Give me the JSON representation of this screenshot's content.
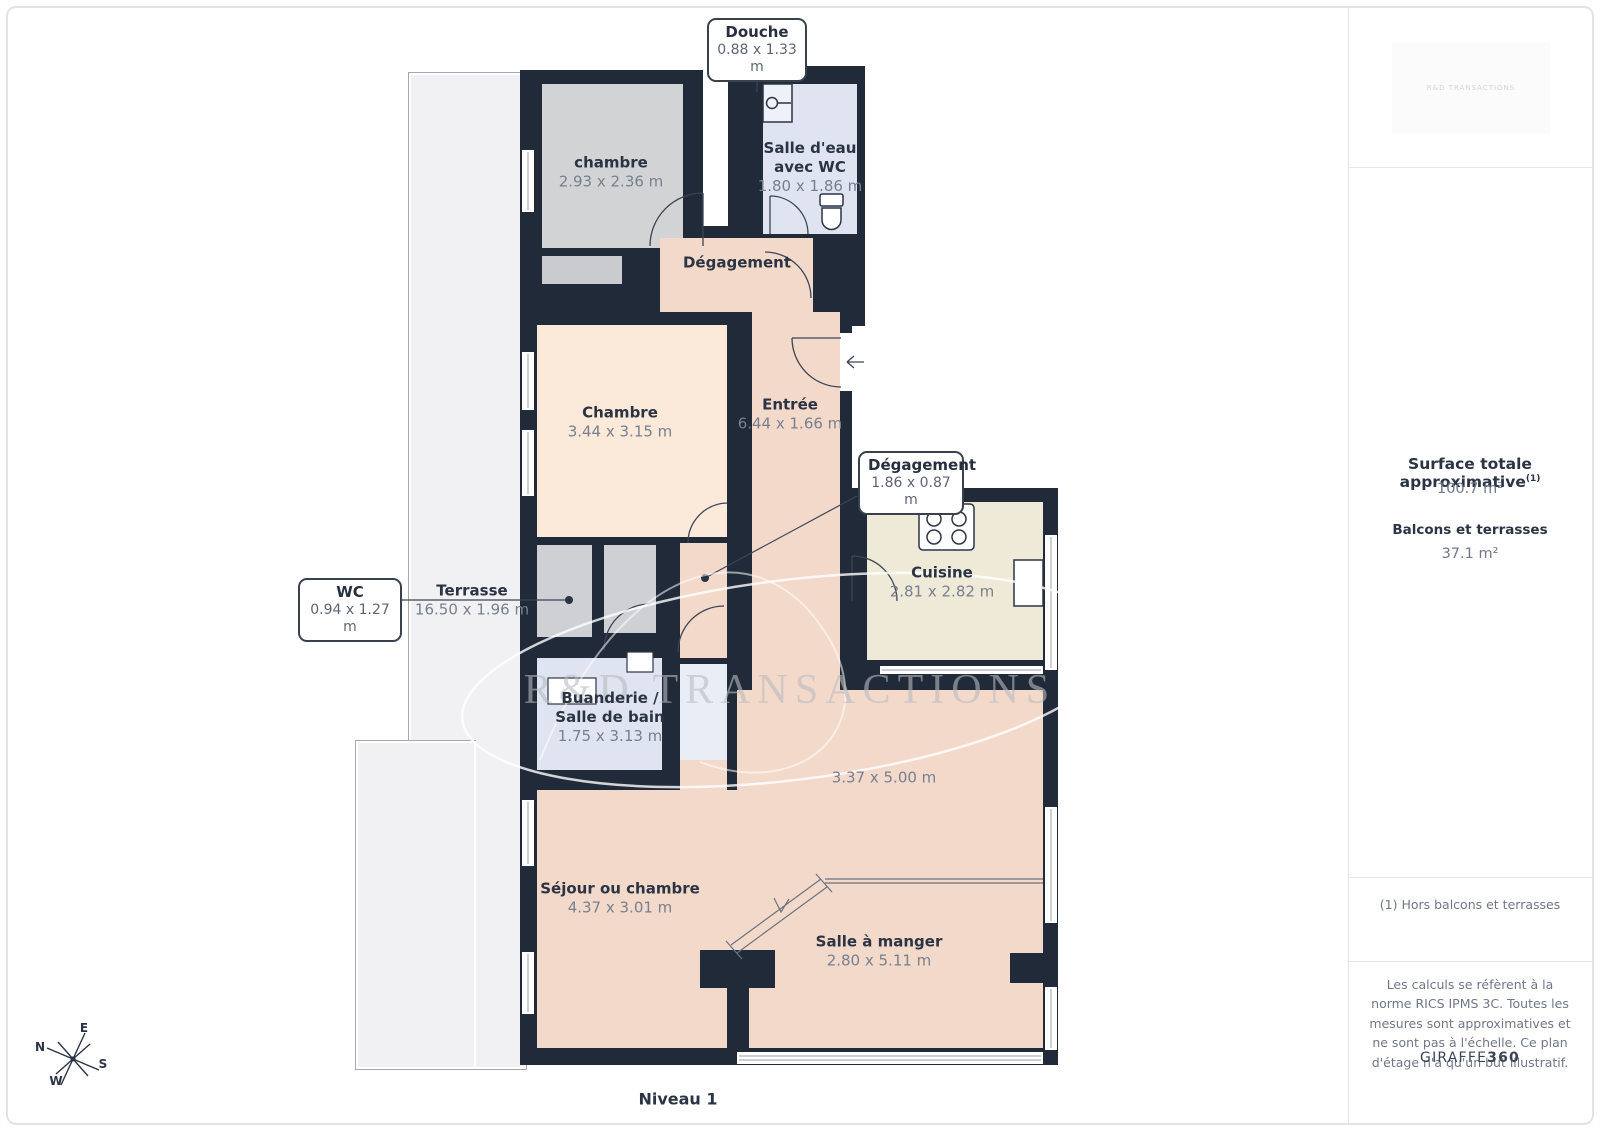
{
  "header": {
    "level_label": "Niveau 1"
  },
  "watermark": {
    "text": "R&D TRANSACTIONS",
    "logo_text": "R&D TRANSACTIONS"
  },
  "plan": {
    "rooms": [
      {
        "id": "chambre-1",
        "name": "chambre",
        "dims": "2.93 x 2.36 m"
      },
      {
        "id": "salle-deau",
        "name": "Salle d'eau avec WC",
        "dims": "1.80 x 1.86 m"
      },
      {
        "id": "degagement",
        "name": "Dégagement",
        "dims": ""
      },
      {
        "id": "chambre-2",
        "name": "Chambre",
        "dims": "3.44 x 3.15 m"
      },
      {
        "id": "entree",
        "name": "Entrée",
        "dims": "6.44 x 1.66 m"
      },
      {
        "id": "cuisine",
        "name": "Cuisine",
        "dims": "2.81 x 2.82 m"
      },
      {
        "id": "terrasse",
        "name": "Terrasse",
        "dims": "16.50 x 1.96 m"
      },
      {
        "id": "buanderie",
        "name": "Buanderie / Salle de bain",
        "dims": "1.75 x 3.13 m"
      },
      {
        "id": "sejour-zone",
        "name": "",
        "dims": "3.37 x 5.00 m"
      },
      {
        "id": "sejour",
        "name": "Séjour ou chambre",
        "dims": "4.37 x 3.01 m"
      },
      {
        "id": "salle-a-manger",
        "name": "Salle à manger",
        "dims": "2.80 x 5.11 m"
      }
    ],
    "callouts": [
      {
        "title": "Douche",
        "dims": "0.88 x 1.33 m"
      },
      {
        "title": "WC",
        "dims": "0.94 x 1.27 m"
      },
      {
        "title": "Dégagement",
        "dims": "1.86 x 0.87 m"
      }
    ],
    "compass": {
      "n": "N",
      "e": "E",
      "s": "S",
      "w": "W"
    }
  },
  "sidebar": {
    "surface_title": "Surface totale approximative",
    "surface_footnote_mark": "(1)",
    "surface_value": "100.7 m²",
    "balconies_title": "Balcons et terrasses",
    "balconies_value": "37.1 m²",
    "footnote": "(1) Hors balcons et terrasses",
    "disclaimer": "Les calculs se réfèrent à la norme RICS IPMS 3C. Toutes les mesures sont approximatives et ne sont pas à l'échelle. Ce plan d'étage n'a qu'un but illustratif.",
    "brand": "GIRAFFE",
    "brand_suffix": "360"
  }
}
